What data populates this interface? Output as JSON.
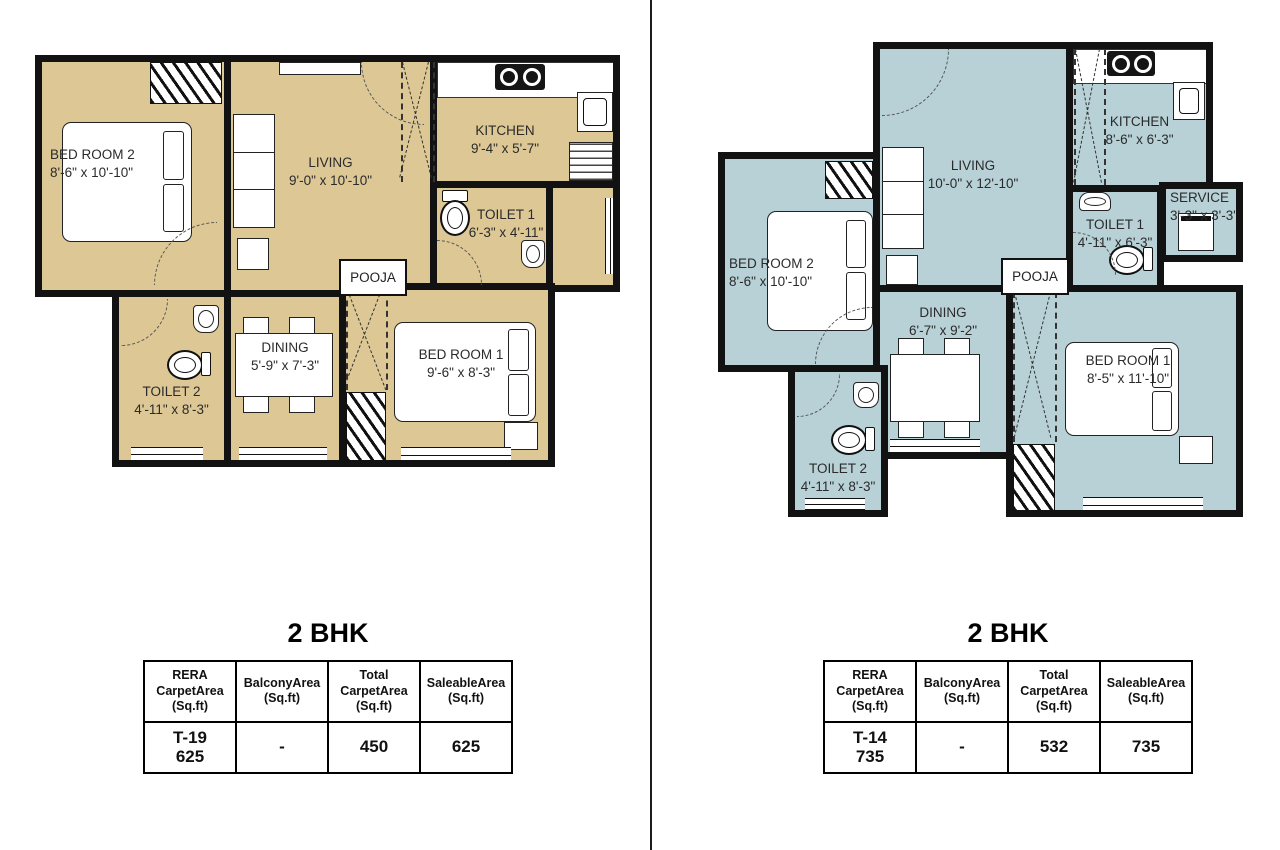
{
  "colors": {
    "left_fill": "#dcc795",
    "right_fill": "#b7d1d6",
    "wall": "#121212"
  },
  "plans": [
    {
      "title": "2 BHK",
      "rooms": {
        "bedroom2": {
          "name": "BED ROOM 2",
          "dims": "8'-6\" x 10'-10\""
        },
        "living": {
          "name": "LIVING",
          "dims": "9'-0\" x 10'-10\""
        },
        "kitchen": {
          "name": "KITCHEN",
          "dims": "9'-4\" x 5'-7\""
        },
        "toilet1": {
          "name": "TOILET 1",
          "dims": "6'-3\" x 4'-11\""
        },
        "pooja": {
          "name": "POOJA"
        },
        "dining": {
          "name": "DINING",
          "dims": "5'-9\" x 7'-3\""
        },
        "toilet2": {
          "name": "TOILET 2",
          "dims": "4'-11\" x 8'-3\""
        },
        "bedroom1": {
          "name": "BED ROOM 1",
          "dims": "9'-6\" x 8'-3\""
        }
      },
      "table": {
        "headers": [
          {
            "l1": "RERA Carpet",
            "l2": "Area (Sq.ft)"
          },
          {
            "l1": "Balcony",
            "l2": "Area (Sq.ft)"
          },
          {
            "l1": "Total Carpet",
            "l2": "Area (Sq.ft)"
          },
          {
            "l1": "Saleable",
            "l2": "Area (Sq.ft)"
          }
        ],
        "row": {
          "unit": "T-19",
          "rera": "625",
          "balcony": "-",
          "total": "450",
          "saleable": "625"
        }
      }
    },
    {
      "title": "2 BHK",
      "rooms": {
        "bedroom2": {
          "name": "BED ROOM 2",
          "dims": "8'-6\" x 10'-10\""
        },
        "living": {
          "name": "LIVING",
          "dims": "10'-0\" x 12'-10\""
        },
        "kitchen": {
          "name": "KITCHEN",
          "dims": "8'-6\" x 6'-3\""
        },
        "service": {
          "name": "SERVICE",
          "dims": "3'-3\" x 3'-3\""
        },
        "toilet1": {
          "name": "TOILET 1",
          "dims": "4'-11\" x 6'-3\""
        },
        "pooja": {
          "name": "POOJA"
        },
        "dining": {
          "name": "DINING",
          "dims": "6'-7\" x 9'-2\""
        },
        "toilet2": {
          "name": "TOILET 2",
          "dims": "4'-11\" x 8'-3\""
        },
        "bedroom1": {
          "name": "BED ROOM 1",
          "dims": "8'-5\" x 11'-10\""
        }
      },
      "table": {
        "headers": [
          {
            "l1": "RERA Carpet",
            "l2": "Area (Sq.ft)"
          },
          {
            "l1": "Balcony",
            "l2": "Area (Sq.ft)"
          },
          {
            "l1": "Total Carpet",
            "l2": "Area (Sq.ft)"
          },
          {
            "l1": "Saleable",
            "l2": "Area (Sq.ft)"
          }
        ],
        "row": {
          "unit": "T-14",
          "rera": "735",
          "balcony": "-",
          "total": "532",
          "saleable": "735"
        }
      }
    }
  ]
}
